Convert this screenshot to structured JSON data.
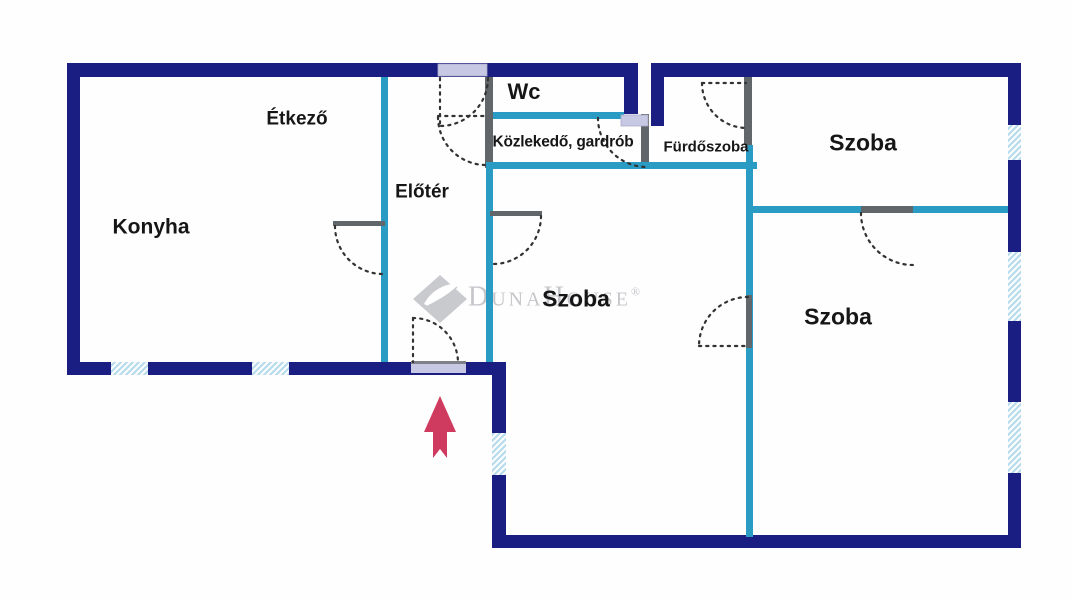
{
  "floorplan": {
    "rooms": [
      {
        "name": "etkezo",
        "label": "Étkező"
      },
      {
        "name": "konyha",
        "label": "Konyha"
      },
      {
        "name": "eloter",
        "label": "Előtér"
      },
      {
        "name": "wc",
        "label": "Wc"
      },
      {
        "name": "kozlekedo-gardrob",
        "label": "Közlekedő, gardrób"
      },
      {
        "name": "furdoszoba",
        "label": "Fürdőszoba"
      },
      {
        "name": "szoba-top-right",
        "label": "Szoba"
      },
      {
        "name": "szoba-center",
        "label": "Szoba"
      },
      {
        "name": "szoba-bottom-right",
        "label": "Szoba"
      }
    ],
    "watermark": {
      "brand": "DunaHouse",
      "registered_mark": "®"
    },
    "icons": [
      "entrance-arrow-icon",
      "dunahouse-logo-icon"
    ],
    "colors": {
      "outer_wall": "#1a1d82",
      "inner_wall_teal": "#2a9cc4",
      "partition_gray": "#60666a",
      "door_fill_lavender": "#c7c8e4",
      "window_hatch_blue": "#b9dcec",
      "entrance_arrow_red": "#ce3b5f",
      "watermark_gray": "#c5c6ca",
      "label_text": "#161616"
    }
  }
}
